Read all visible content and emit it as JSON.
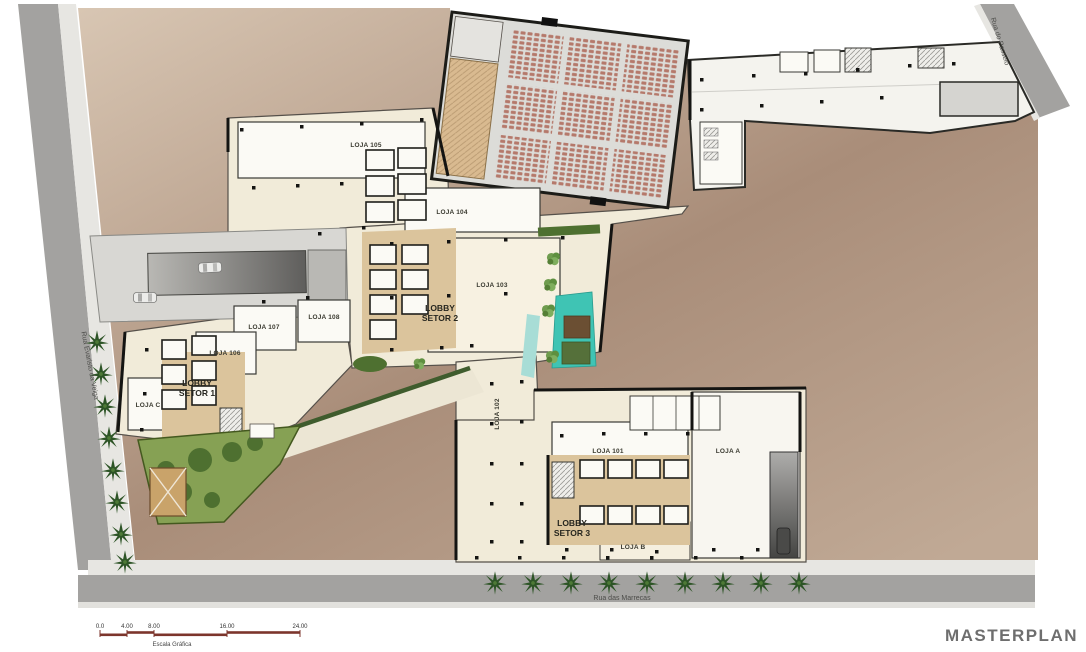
{
  "title": "MASTERPLAN",
  "streets": {
    "left": "Rua Evaristo da Veiga",
    "right": "Rua do Passeio",
    "bottom": "Rua das Marrecas"
  },
  "rooms": {
    "loja_105": "LOJA 105",
    "loja_104": "LOJA 104",
    "loja_103": "LOJA 103",
    "loja_102": "LOJA 102",
    "loja_101": "LOJA 101",
    "loja_106": "LOJA 106",
    "loja_107": "LOJA 107",
    "loja_108": "LOJA 108",
    "loja_a": "LOJA A",
    "loja_b": "LOJA B",
    "loja_c": "LOJA C"
  },
  "lobbies": {
    "setor1_line1": "LOBBY",
    "setor1_line2": "SETOR 1",
    "setor2_line1": "LOBBY",
    "setor2_line2": "SETOR 2",
    "setor3_line1": "LOBBY",
    "setor3_line2": "SETOR 3"
  },
  "scalebar": {
    "ticks": [
      "0.0",
      "4.00",
      "8.00",
      "16.00",
      "24.00"
    ],
    "caption": "Escala Gráfica"
  },
  "colors": {
    "site_light": "#d8c6b3",
    "site_dark": "#a98d79",
    "street": "#a3a2a0",
    "sidewalk": "#e7e6e2",
    "building": "#f1ebd9",
    "room_white": "#fbfaf5",
    "lobby": "#dbc49c",
    "pool": "#3fc4b4",
    "seats": "#b5796b",
    "stage": "#d9ba90",
    "palm": "#2d5426",
    "tree": "#6f9c4e",
    "garden": "#86a154",
    "scalebar": "#7c352c",
    "title": "#6e6e6e"
  }
}
